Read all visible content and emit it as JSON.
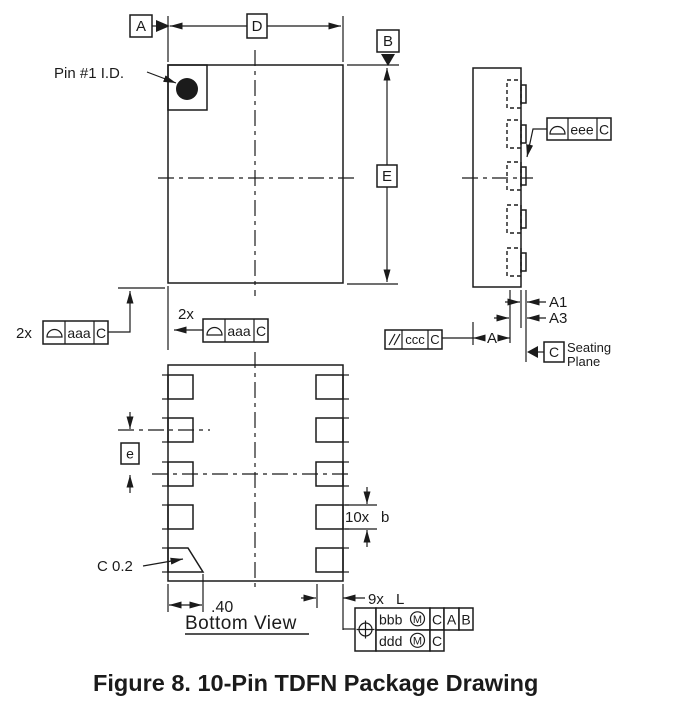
{
  "drawing": {
    "caption": "Figure 8. 10-Pin TDFN Package Drawing",
    "top_view": {
      "pin1_label": "Pin #1 I.D.",
      "datum_a": "A",
      "datum_b": "B",
      "dim_d": "D",
      "dim_e": "E",
      "mult_left": "2x",
      "mult_mid": "2x"
    },
    "side_view": {
      "dim_a1": "A1",
      "dim_a3": "A3",
      "dim_a": "A",
      "datum_c": "C",
      "seating_line1": "Seating",
      "seating_line2": "Plane"
    },
    "bottom_view": {
      "title": "Bottom View",
      "dim_e_pitch": "e",
      "lead_count_b": "10x",
      "dim_b": "b",
      "lead_count_l": "9x",
      "dim_l": "L",
      "dim_p40": ".40",
      "chamfer_note": "C 0.2"
    },
    "fcf": {
      "aaa_left": {
        "tol": "aaa",
        "datum": "C"
      },
      "aaa_mid": {
        "tol": "aaa",
        "datum": "C"
      },
      "ccc": {
        "tol": "ccc",
        "datum": "C"
      },
      "eee": {
        "tol": "eee",
        "datum": "C"
      },
      "position": {
        "row1": {
          "tol": "bbb",
          "mod": "M",
          "d1": "C",
          "d2": "A",
          "d3": "B"
        },
        "row2": {
          "tol": "ddd",
          "mod": "M",
          "d1": "C"
        }
      }
    },
    "icons": {
      "profile_of_surface": "dome-half-circle",
      "parallelism": "double-slash",
      "true_position": "circle-cross",
      "datum_arrow": "filled-triangle",
      "pin1_id": "filled-dot"
    }
  }
}
